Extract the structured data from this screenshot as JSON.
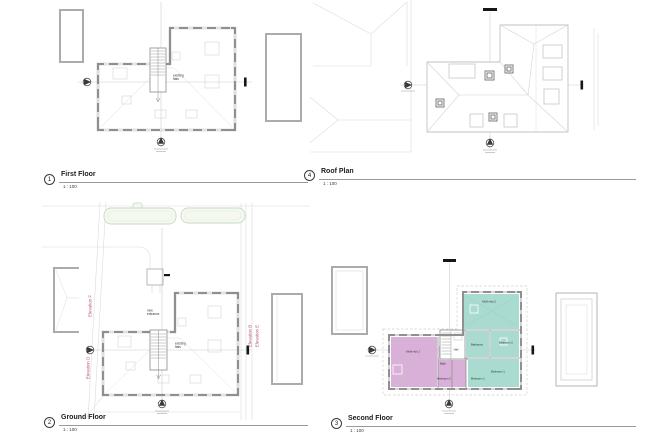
{
  "views": {
    "first_floor": {
      "number": "1",
      "title": "First Floor",
      "scale": "1 : 100"
    },
    "roof_plan": {
      "number": "4",
      "title": "Roof Plan",
      "scale": "1 : 100"
    },
    "ground_floor": {
      "number": "2",
      "title": "Ground Floor",
      "scale": "1 : 100"
    },
    "second_floor": {
      "number": "3",
      "title": "Second Floor",
      "scale": "1 : 100"
    }
  },
  "annotations": {
    "first_floor": {
      "stair_note": "existing\nflats"
    },
    "ground_floor": {
      "entrance_note": "new\nentrance",
      "stair_note": "existing\nflats",
      "elevations": {
        "left_upper": "Elevation F",
        "left_lower": "Elevation D",
        "right_inner": "Elevation B",
        "right_outer": "Elevation E"
      }
    },
    "second_floor": {
      "rooms": {
        "kitliv_2": "Kit/liv Apt 2",
        "bathroom_2": "Bathroom",
        "bedroom2_2": "Bedroom 2",
        "bedroom1_2": "Bedroom 1",
        "hall": "Hall",
        "bath_1": "Bath",
        "kitliv_1": "Kit/liv Apt 1",
        "bedroom2_1": "Bedroom 2",
        "bedroom1_1": "Bedroom 1"
      }
    }
  },
  "colors": {
    "apartment_1_fill": "#d9b0d7",
    "apartment_2_fill": "#a9dbd0",
    "elevation_label": "#b5576b",
    "main_walls": "#8f8f8f",
    "neighbour_walls": "#ababab",
    "hedge": "#c9dac1",
    "section_marks": "#161616"
  }
}
